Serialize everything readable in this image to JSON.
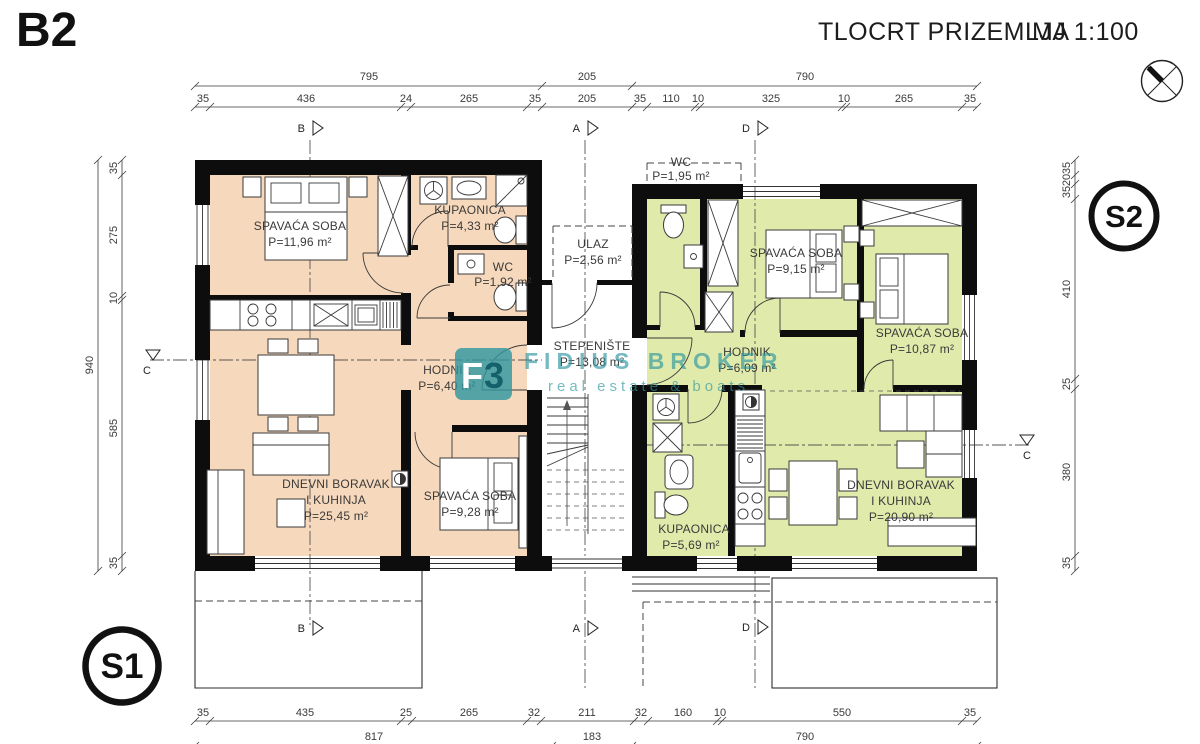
{
  "header": {
    "sheet_label": "B2",
    "title": "TLOCRT PRIZEMLJA",
    "scale": "MJ 1:100"
  },
  "watermark": {
    "logo_f": "F",
    "logo_3": "3",
    "brand": "FIDIUS BROKER",
    "tagline": "real estate & boats"
  },
  "badges": {
    "s1": "S1",
    "s2": "S2"
  },
  "section_markers": {
    "a": "A",
    "b": "B",
    "c": "C",
    "d": "D"
  },
  "colors": {
    "apartment_left_fill": "#f6d8bc",
    "apartment_right_fill": "#e0ebab",
    "watermark_teal": "#2e96a0",
    "logo_dark": "#15616b"
  },
  "apartment_left": {
    "bedroom1": {
      "name": "SPAVAĆA SOBA",
      "area": "P=11,96 m²"
    },
    "bathroom": {
      "name": "KUPAONICA",
      "area": "P=4,33 m²"
    },
    "wc": {
      "name": "WC",
      "area": "P=1,92 m²"
    },
    "hallway": {
      "name": "HODNIK",
      "area": "P=6,40 m²"
    },
    "living": {
      "name_line1": "DNEVNI BORAVAK",
      "name_line2": "I KUHINJA",
      "area": "P=25,45 m²"
    },
    "bedroom2": {
      "name": "SPAVAĆA SOBA",
      "area": "P=9,28 m²"
    }
  },
  "core": {
    "entrance": {
      "name": "ULAZ",
      "area": "P=2,56 m²"
    },
    "staircase": {
      "name": "STEPENIŠTE",
      "area": "P=13,08 m²"
    }
  },
  "apartment_right": {
    "wc": {
      "name": "WC",
      "area": "P=1,95 m²"
    },
    "bedroom1": {
      "name": "SPAVAĆA SOBA",
      "area": "P=9,15 m²"
    },
    "bedroom2": {
      "name": "SPAVAĆA SOBA",
      "area": "P=10,87 m²"
    },
    "hallway": {
      "name": "HODNIK",
      "area": "P=6,09 m²"
    },
    "bathroom": {
      "name": "KUPAONICA",
      "area": "P=5,69 m²"
    },
    "living": {
      "name_line1": "DNEVNI BORAVAK",
      "name_line2": "I KUHINJA",
      "area": "P=20,90 m²"
    }
  },
  "dimensions": {
    "top_row1": [
      "795",
      "205",
      "790"
    ],
    "top_row2": [
      "35",
      "436",
      "24",
      "265",
      "35",
      "205",
      "35",
      "110",
      "10",
      "325",
      "10",
      "265",
      "35"
    ],
    "bottom_row1": [
      "35",
      "435",
      "25",
      "265",
      "32",
      "211",
      "32",
      "160",
      "10",
      "550",
      "35"
    ],
    "bottom_row2": [
      "817",
      "183",
      "790"
    ],
    "left_inner": [
      "35",
      "275",
      "10",
      "585",
      "35"
    ],
    "left_total": "940",
    "right_inner": [
      "35",
      "20",
      "35",
      "410",
      "25",
      "380",
      "35"
    ]
  }
}
